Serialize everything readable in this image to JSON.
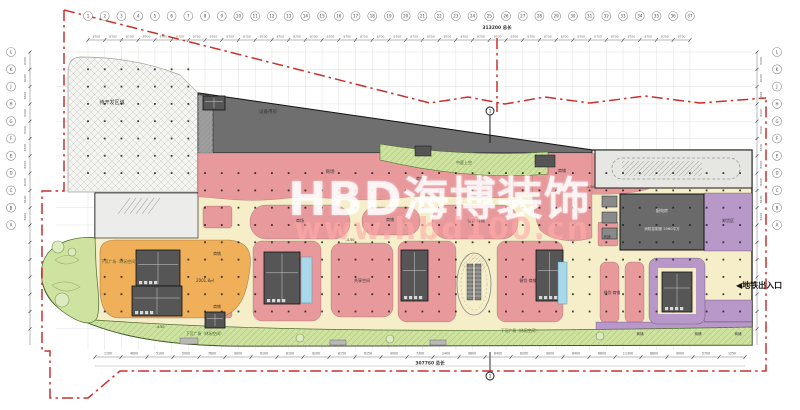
{
  "watermark": {
    "brand": "HBD海博装饰",
    "site": "www.hbd100.cn"
  },
  "annotations": {
    "subway_exit": "◀地铁出入口",
    "section_mark": "1"
  },
  "grid": {
    "columns": [
      "1",
      "2",
      "3",
      "4",
      "5",
      "6",
      "7",
      "8",
      "9",
      "10",
      "11",
      "12",
      "13",
      "14",
      "15",
      "16",
      "17",
      "18",
      "19",
      "20",
      "21",
      "22",
      "23",
      "24",
      "25",
      "26",
      "27",
      "28",
      "29",
      "30",
      "31",
      "32",
      "33",
      "34",
      "35",
      "36",
      "37"
    ],
    "rows": [
      "L",
      "K",
      "J",
      "H",
      "G",
      "F",
      "E",
      "D",
      "C",
      "B",
      "A"
    ]
  },
  "dims": {
    "top_bay": "8700",
    "top_total": "313200 总长",
    "side_bay": "8400",
    "bottom_total": "307760 总长",
    "bottom_values": [
      "1100",
      "4600",
      "5100",
      "5000",
      "7800",
      "9000",
      "8100",
      "8100",
      "9200",
      "8150",
      "8150",
      "9000",
      "7300",
      "2400",
      "9800",
      "8400",
      "8200",
      "9000",
      "8400",
      "6600",
      "11300",
      "8600",
      "9000",
      "5700",
      "1250"
    ]
  },
  "zones": [
    {
      "t": "待开发区域",
      "x": 112,
      "y": 104,
      "s": 5
    },
    {
      "t": "设备用房",
      "x": 268,
      "y": 113,
      "s": 4.5
    },
    {
      "t": "商场",
      "x": 330,
      "y": 173,
      "s": 4.5
    },
    {
      "t": "商铺",
      "x": 420,
      "y": 180,
      "s": 4
    },
    {
      "t": "中庭上空",
      "x": 464,
      "y": 164,
      "s": 4,
      "c": "#3d5c1f"
    },
    {
      "t": "商铺",
      "x": 562,
      "y": 172,
      "s": 4
    },
    {
      "t": "商场",
      "x": 300,
      "y": 222,
      "s": 4
    },
    {
      "t": "商铺",
      "x": 390,
      "y": 221,
      "s": 4
    },
    {
      "t": "餐饮·商铺",
      "x": 476,
      "y": 222,
      "s": 4
    },
    {
      "t": "商铺",
      "x": 217,
      "y": 255,
      "s": 3.8
    },
    {
      "t": "商铺",
      "x": 217,
      "y": 308,
      "s": 3.8
    },
    {
      "t": "2001.8㎡",
      "x": 205,
      "y": 282,
      "s": 4
    },
    {
      "t": "共享空间",
      "x": 362,
      "y": 282,
      "s": 4
    },
    {
      "t": "餐饮·商铺",
      "x": 528,
      "y": 282,
      "s": 4
    },
    {
      "t": "餐饮·商铺",
      "x": 612,
      "y": 294,
      "s": 3.8
    },
    {
      "t": "配电房",
      "x": 662,
      "y": 212,
      "s": 4,
      "c": "#e6e6e6"
    },
    {
      "t": "消防控制室 2560平方",
      "x": 662,
      "y": 230,
      "s": 3.6,
      "c": "#e6e6e6"
    },
    {
      "t": "卸货区",
      "x": 728,
      "y": 222,
      "s": 4
    },
    {
      "t": "商铺",
      "x": 607,
      "y": 238,
      "s": 3.5
    },
    {
      "t": "下沉广场（休闲空间）",
      "x": 120,
      "y": 263,
      "s": 3.8,
      "c": "#3d5c1f"
    },
    {
      "t": "下沉广场（休闲空间）",
      "x": 205,
      "y": 335,
      "s": 3.8,
      "c": "#3d5c1f"
    },
    {
      "t": "下沉广场（休闲空间）",
      "x": 520,
      "y": 332,
      "s": 3.8,
      "c": "#3d5c1f"
    },
    {
      "t": "-4.50",
      "x": 160,
      "y": 328,
      "s": 3.5
    },
    {
      "t": "-4.50",
      "x": 350,
      "y": 241,
      "s": 3.5
    },
    {
      "t": "-4.50",
      "x": 590,
      "y": 188,
      "s": 3.5
    },
    {
      "t": "商铺",
      "x": 640,
      "y": 335,
      "s": 3.5
    },
    {
      "t": "商铺",
      "x": 698,
      "y": 335,
      "s": 3.5
    },
    {
      "t": "商铺",
      "x": 738,
      "y": 335,
      "s": 3.5
    }
  ],
  "colors": {
    "retail_pink": "#e8999c",
    "mall_orange": "#f0b05a",
    "landscape_green": "#cfe3a0",
    "supermarket_purple": "#b897c9",
    "equipment_gray": "#6f6f6f",
    "walkway_cream": "#f6eec9",
    "water_cyan": "#a8d8ea",
    "boundary_red": "#c9302c"
  }
}
